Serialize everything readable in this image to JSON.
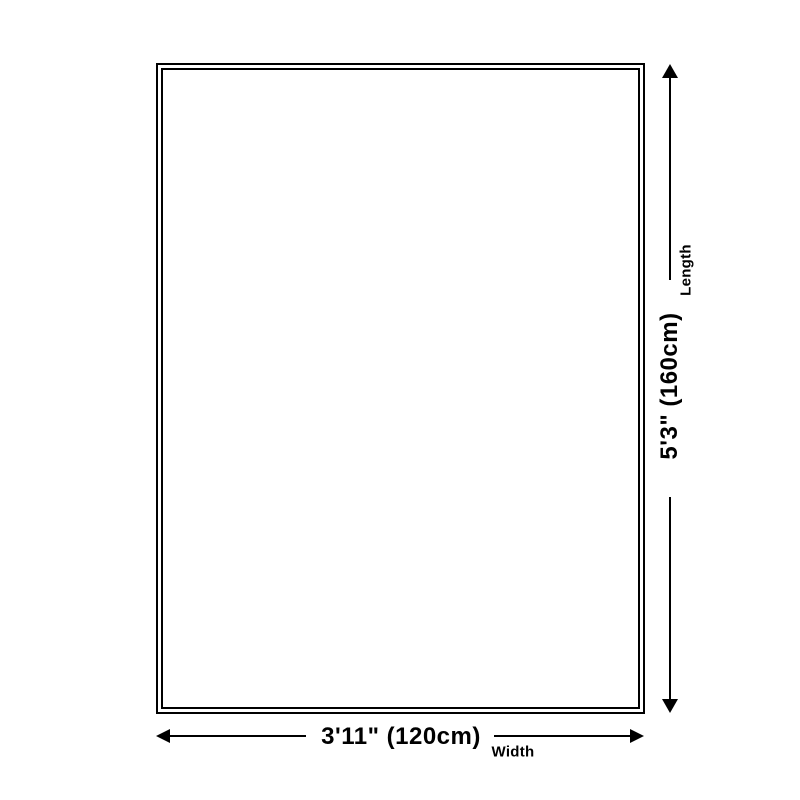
{
  "diagram": {
    "length": {
      "value": "5'3\" (160cm)",
      "axis_label": "Length"
    },
    "width": {
      "value": "3'11\" (120cm)",
      "axis_label": "Width"
    },
    "colors": {
      "line": "#000000",
      "background": "#ffffff"
    }
  }
}
